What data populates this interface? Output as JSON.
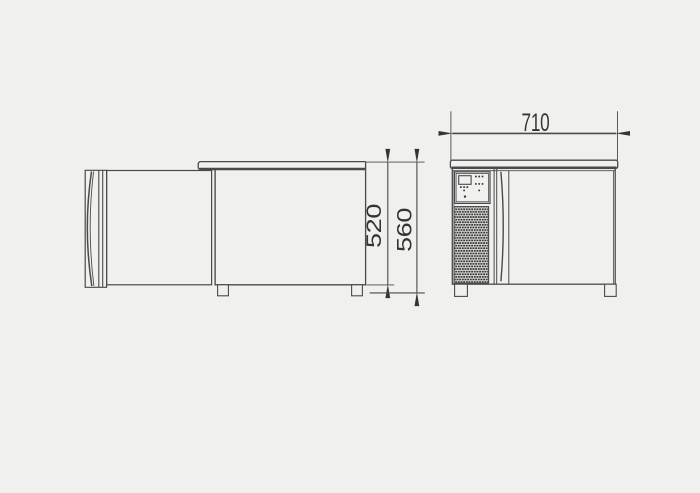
{
  "colors": {
    "background": "#f0f0ee",
    "line": "#4a4a4a",
    "ink": "#343434"
  },
  "dimensions": {
    "front_width": {
      "label": "710"
    },
    "body_height": {
      "label": "520"
    },
    "overall_height": {
      "label": "560"
    }
  }
}
